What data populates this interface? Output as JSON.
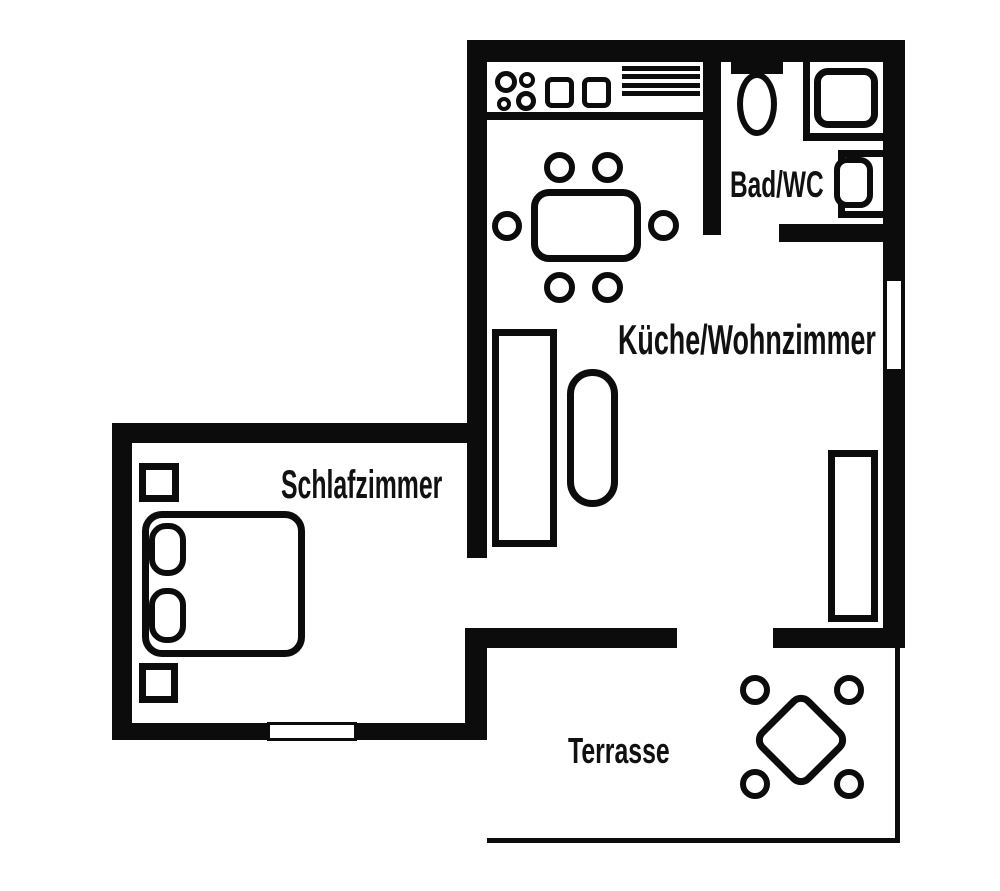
{
  "rooms": [
    {
      "name": "kitchen-living",
      "label": "Küche/Wohnzimmer"
    },
    {
      "name": "bathroom",
      "label": "Bad/WC"
    },
    {
      "name": "bedroom",
      "label": "Schlafzimmer"
    },
    {
      "name": "terrace",
      "label": "Terrasse"
    }
  ],
  "fixtures": {
    "kitchen_living": [
      "stove-burners",
      "double-sink",
      "counter-drainer",
      "dining-table",
      "dining-chairs",
      "sofa",
      "armchair",
      "sideboard"
    ],
    "bathroom": [
      "toilet",
      "shower",
      "washbasin"
    ],
    "bedroom": [
      "double-bed",
      "pillows",
      "nightstands"
    ],
    "terrace": [
      "terrace-table",
      "terrace-chairs"
    ]
  },
  "windows": [
    "right-wall-window",
    "bedroom-window"
  ],
  "colors": {
    "wall": "#0c0c0c",
    "background": "#ffffff"
  }
}
